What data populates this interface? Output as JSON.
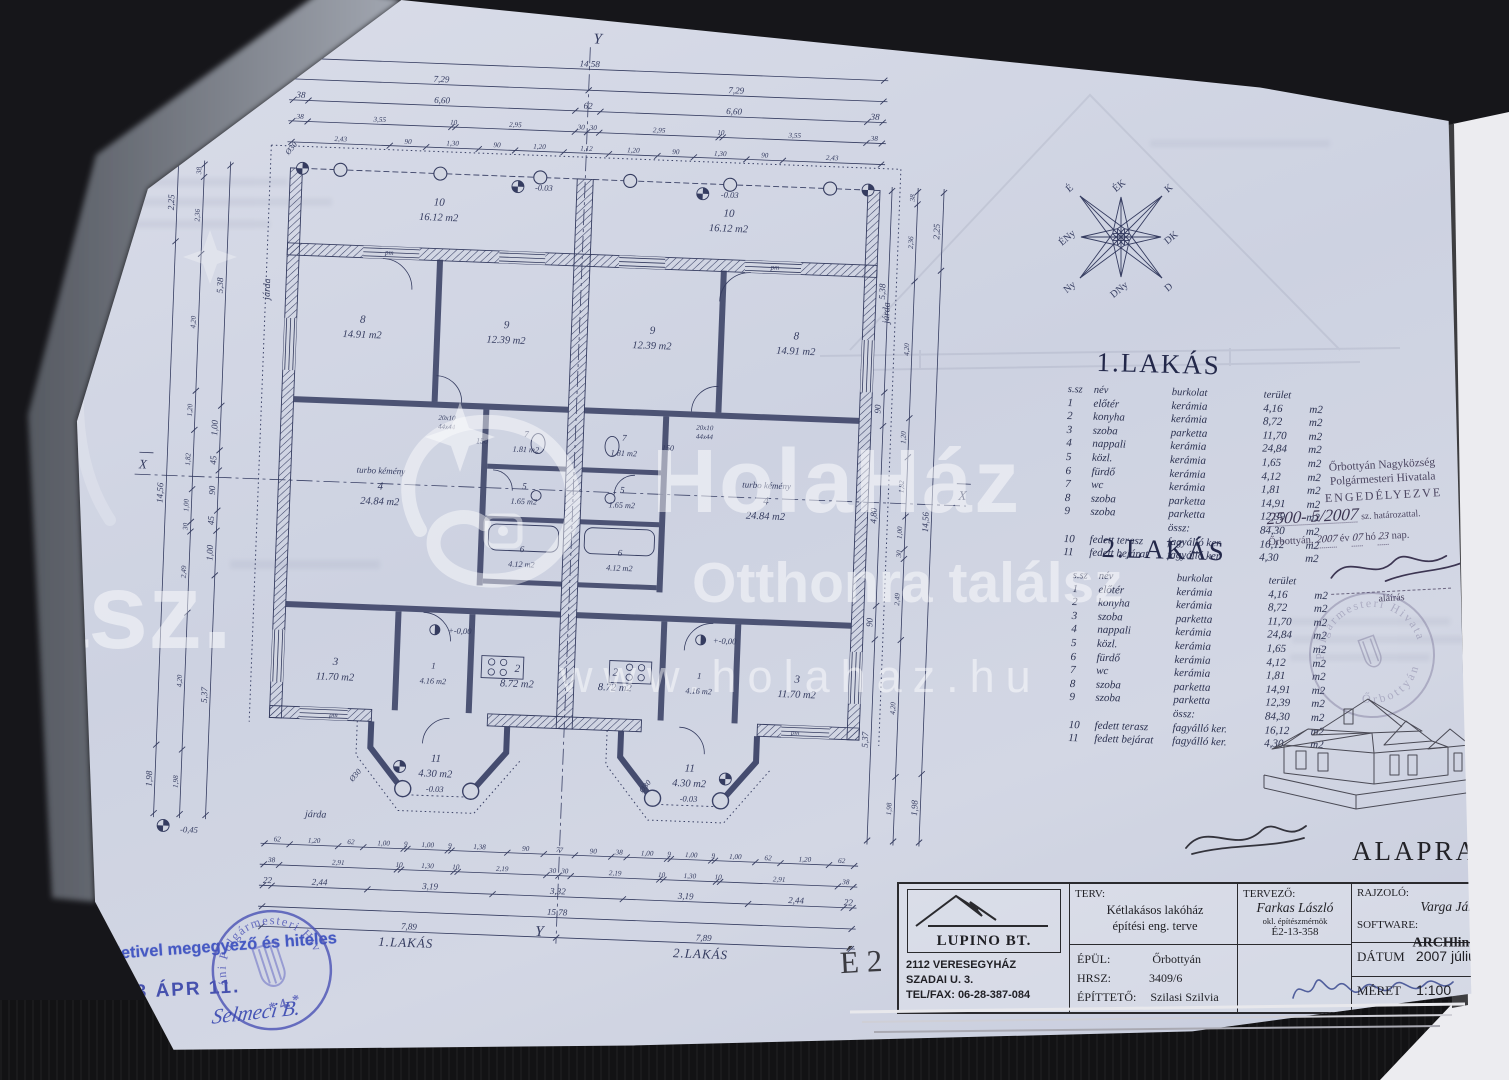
{
  "photo_colors": {
    "paper": "#d2d6e2",
    "ink": "#353c60",
    "stamp_blue": "#3d49b4",
    "background": "#141416"
  },
  "watermark": {
    "brand": "HolaHáz",
    "tagline": "Otthonra találsz",
    "url": "www.holahaz.hu",
    "partial_left": "ász."
  },
  "compass": {
    "labels": [
      "É",
      "ÉK",
      "K",
      "DK",
      "D",
      "DNy",
      "Ny",
      "ÉNy"
    ]
  },
  "floor_plan": {
    "axes": {
      "horizontal": "X",
      "vertical": "Y"
    },
    "unit_labels": [
      "1.LAKÁS",
      "2.LAKÁS"
    ],
    "rooms": [
      {
        "no": "10",
        "area": "16.12 m2"
      },
      {
        "no": "8",
        "area": "14.91 m2"
      },
      {
        "no": "9",
        "area": "12.39 m2"
      },
      {
        "no": "4",
        "area": "24.84 m2"
      },
      {
        "no": "7",
        "area": "1.81 m2"
      },
      {
        "no": "5",
        "area": "1.65 m2"
      },
      {
        "no": "6",
        "area": "4.12 m2"
      },
      {
        "no": "3",
        "area": "11.70 m2"
      },
      {
        "no": "1",
        "area": "4.16 m2"
      },
      {
        "no": "2",
        "area": "8.72 m2"
      },
      {
        "no": "11",
        "area": "4.30 m2"
      }
    ],
    "annotations": {
      "chimney": "turbo kémény",
      "sidewalk": "járda",
      "column_dia": "Ø30",
      "pm": "pm",
      "flue_size_1": "20x10",
      "flue_size_2": "44x44",
      "len_150": "150",
      "level_zero": "+-0,00",
      "level_minus": "-0.03",
      "level_base": "-0,45"
    },
    "dims": {
      "top": [
        [
          "14,58"
        ],
        [
          "7,29",
          "7,29"
        ],
        [
          "38",
          "6,60",
          "62",
          "6,60",
          "38"
        ],
        [
          "38",
          "3,55",
          "10",
          "2,95",
          "30",
          "30",
          "2,95",
          "10",
          "3,55",
          "38"
        ],
        [
          "2,43",
          "90",
          "1,30",
          "90",
          "1,20",
          "1,12",
          "1,20",
          "90",
          "1,30",
          "90",
          "2,43"
        ]
      ],
      "bottom": [
        [
          "62",
          "1,20",
          "62",
          "1,00",
          "9",
          "1,00",
          "9",
          "1,38",
          "90",
          "77",
          "90",
          "38",
          "1,00",
          "9",
          "1,00",
          "9",
          "1,00",
          "62",
          "1,20",
          "62"
        ],
        [
          "38",
          "2,91",
          "10",
          "1,30",
          "10",
          "2,19",
          "30",
          "30",
          "2,19",
          "10",
          "1,30",
          "10",
          "2,91",
          "38"
        ],
        [
          "22",
          "2,44",
          "3,19",
          "3,32",
          "3,19",
          "2,44",
          "22"
        ],
        [
          "15,78"
        ],
        [
          "7,89",
          "7,89"
        ]
      ],
      "left": [
        [
          "2,25",
          "14,56",
          "1,98"
        ],
        [
          "38",
          "2,36",
          "4,20",
          "1,20",
          "1,82",
          "1,00",
          "30",
          "2,49",
          "4,20",
          "1,98"
        ],
        [
          "5,38",
          "1,00",
          "45",
          "90",
          "45",
          "1,00",
          "5,37"
        ]
      ],
      "right": [
        [
          "5,38",
          "90",
          "4,80",
          "90",
          "5,37"
        ],
        [
          "38",
          "2,36",
          "4,20",
          "1,20",
          "1,82",
          "1,00",
          "30",
          "2,49",
          "4,20",
          "1,98"
        ],
        [
          "2,25",
          "14,56",
          "1,98"
        ]
      ]
    }
  },
  "area_tables": {
    "titles": [
      "1.LAKÁS",
      "2.LAKÁS"
    ],
    "headers": [
      "s.sz",
      "név",
      "burkolat",
      "terület"
    ],
    "unit": "m2",
    "rows": [
      [
        "1",
        "előtér",
        "kerámia",
        "4,16"
      ],
      [
        "2",
        "konyha",
        "kerámia",
        "8,72"
      ],
      [
        "3",
        "szoba",
        "parketta",
        "11,70"
      ],
      [
        "4",
        "nappali",
        "kerámia",
        "24,84"
      ],
      [
        "5",
        "közl.",
        "kerámia",
        "1,65"
      ],
      [
        "6",
        "fürdő",
        "kerámia",
        "4,12"
      ],
      [
        "7",
        "wc",
        "kerámia",
        "1,81"
      ],
      [
        "8",
        "szoba",
        "parketta",
        "14,91"
      ],
      [
        "9",
        "szoba",
        "parketta",
        "12,39"
      ]
    ],
    "total": {
      "label": "össz:",
      "value": "84,30"
    },
    "extra_rows": [
      [
        "10",
        "fedett terasz",
        "fagyálló ker.",
        "16,12"
      ],
      [
        "11",
        "fedett bejárat",
        "fagyálló ker.",
        "4,30"
      ]
    ]
  },
  "permit_stamp": {
    "office_line1": "Őrbottyán Nagyközség",
    "office_line2": "Polgármesteri Hivatala",
    "approved": "ENGEDÉLYEZVE",
    "case_number": "2500- 5/2007",
    "case_suffix": "sz. határozattal.",
    "place": "Őrbottyán,",
    "year": "2007",
    "year_label": "év",
    "month": "07",
    "month_label": "hó",
    "day": "23",
    "day_label": "nap.",
    "signature_label": "aláírás",
    "seal_line1": "Polgármesteri Hivatal",
    "seal_line2": "Őrbottyán"
  },
  "drawing_title": "ALAPRAJZ",
  "sheet_number": "É 2",
  "title_block": {
    "company": "LUPINO BT.",
    "address_line1": "2112 VERESEGYHÁZ",
    "address_line2": "SZADAI U. 3.",
    "address_line3": "TEL/FAX: 06-28-387-084",
    "plan_label": "TERV:",
    "plan_line1": "Kétlakásos lakóház",
    "plan_line2": "építési eng. terve",
    "site_label": "ÉPÜL:",
    "site": "Őrbottyán",
    "parcel_label": "HRSZ:",
    "parcel": "3409/6",
    "client_label": "ÉPÍTTETŐ:",
    "client": "Szilasi Szilvia",
    "designer_label": "TERVEZŐ:",
    "designer": "Farkas László",
    "designer_title": "okl. építészmérnök",
    "designer_reg": "É2-13-358",
    "draftsman_label": "RAJZOLÓ:",
    "draftsman": "Varga János",
    "software_label": "SOFTWARE:",
    "software": "ARCHline",
    "software_sup": "XP",
    "date_label": "DÁTUM",
    "date": "2007 július",
    "scale_label": "MÉRET",
    "scale": "1:100"
  },
  "verification": {
    "stamp_text": "Eredetivel megegyező és hiteles",
    "date_stamp": "2023 ÁPR 11.",
    "seal_text": "áni Polgármesteri Hivatal",
    "seal_number": "4.",
    "signature": "Selmeci B."
  }
}
